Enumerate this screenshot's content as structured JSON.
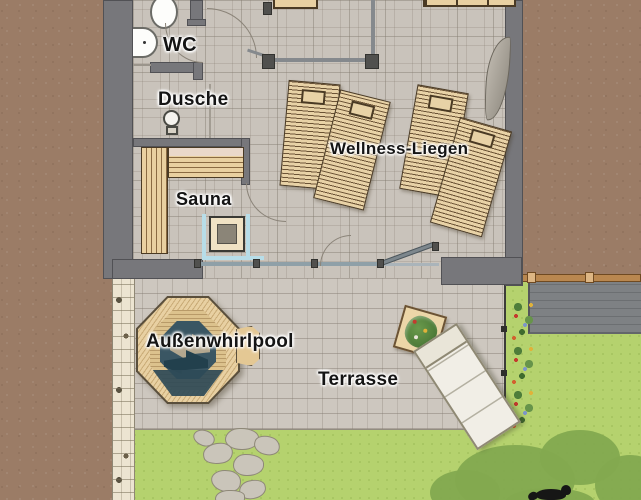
{
  "floorplan": {
    "title": "Wellness area floor plan",
    "labels": {
      "wc": "WC",
      "shower": "Dusche",
      "sauna": "Sauna",
      "loungers": "Wellness-Liegen",
      "whirlpool": "Außenwhirlpool",
      "terrace": "Terrasse"
    },
    "colors": {
      "ground_brown": "#9b7c66",
      "wall_gray": "#77777b",
      "tile_floor": "#c9c3bb",
      "terrace_paver": "#cdc7bf",
      "grass": "#b5d26e",
      "tree_shadow": "#83a94f",
      "wood_furniture": "#e8d0a2",
      "whirlpool_water": "#3a5663",
      "glass_partition": "#b7dde8",
      "deck_gray": "#7e8184",
      "stone_band": "#ece4d1"
    }
  }
}
